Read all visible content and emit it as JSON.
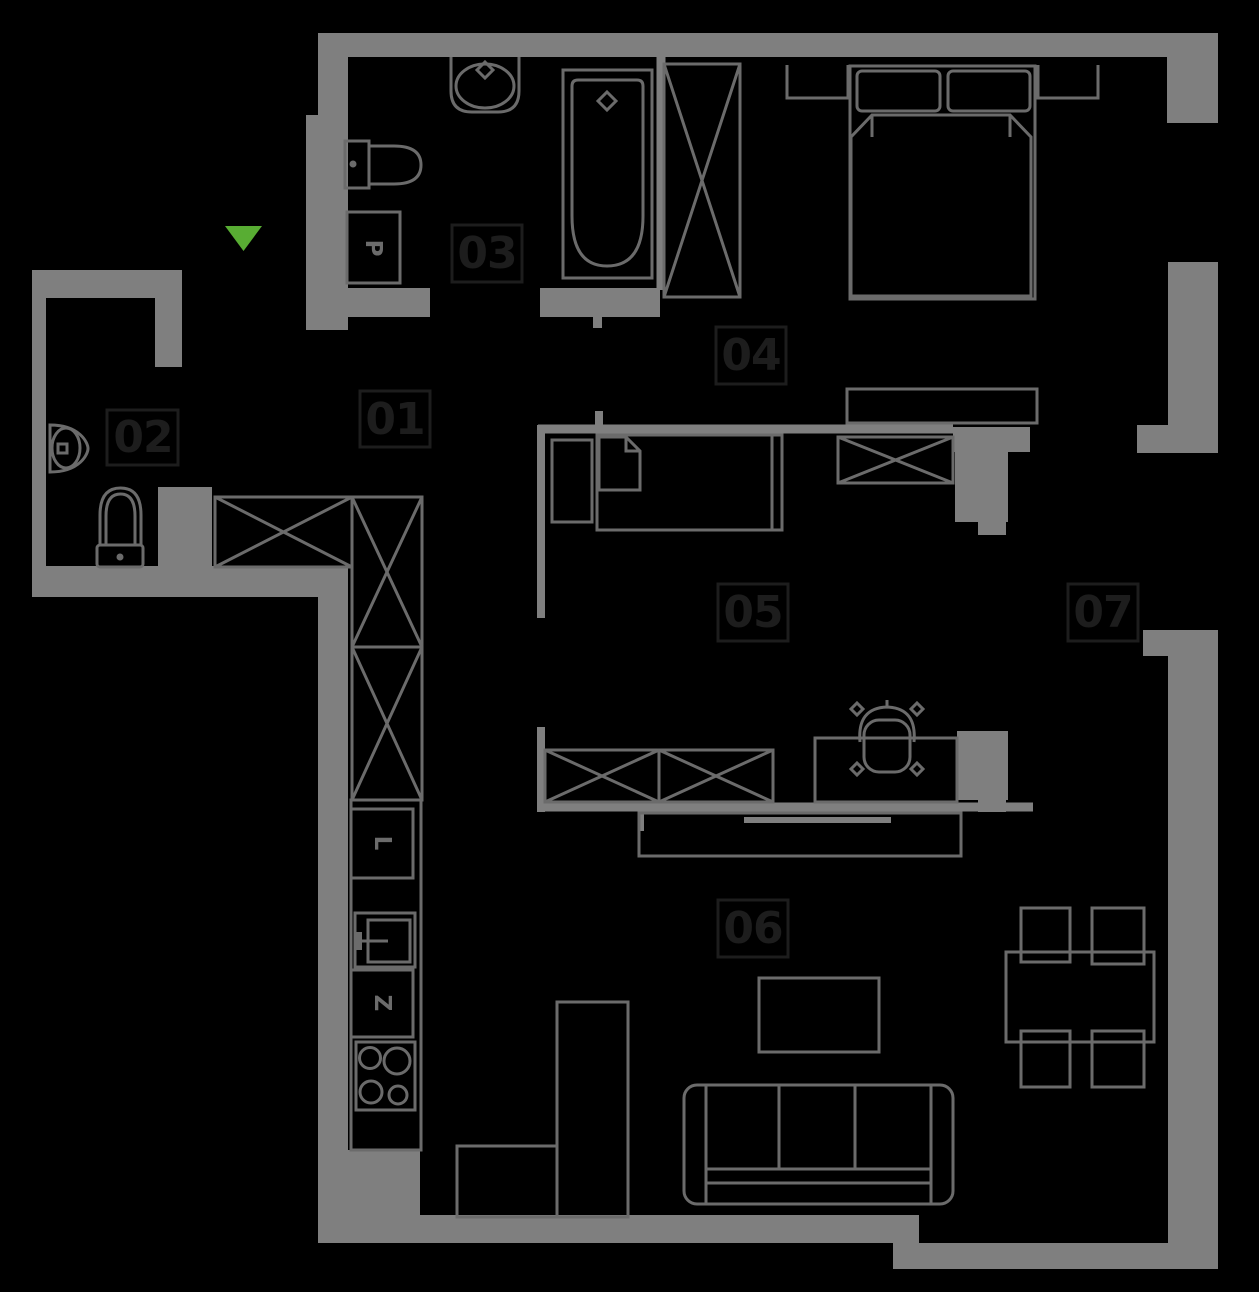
{
  "colors": {
    "background": "#000000",
    "wall": "#7f7f7f",
    "furniture": "#6b6b6b",
    "label": "#1d1d1d",
    "accent_green": "#58ad33"
  },
  "plan": {
    "rooms": [
      {
        "id": "01",
        "label": "01"
      },
      {
        "id": "02",
        "label": "02"
      },
      {
        "id": "03",
        "label": "03"
      },
      {
        "id": "04",
        "label": "04"
      },
      {
        "id": "05",
        "label": "05"
      },
      {
        "id": "06",
        "label": "06"
      },
      {
        "id": "07",
        "label": "07"
      }
    ],
    "appliances": {
      "washing_machine": "P",
      "fridge": "L",
      "dishwasher": "Z"
    },
    "entrance": {
      "marker": "triangle-down"
    }
  }
}
